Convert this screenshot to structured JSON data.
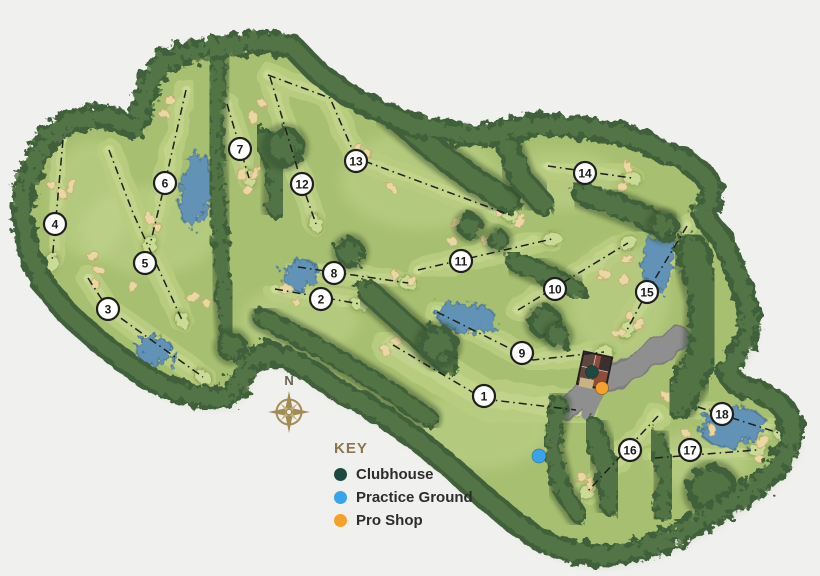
{
  "legend": {
    "title": "KEY",
    "items": [
      {
        "id": "clubhouse",
        "label": "Clubhouse",
        "color": "#1d4a40"
      },
      {
        "id": "practice-ground",
        "label": "Practice Ground",
        "color": "#39a3ec"
      },
      {
        "id": "pro-shop",
        "label": "Pro Shop",
        "color": "#f6a22a"
      }
    ]
  },
  "compass": {
    "label": "N"
  },
  "holes": [
    {
      "number": 1,
      "marker": {
        "x": 484,
        "y": 396
      },
      "route": [
        [
          393,
          345
        ],
        [
          484,
          399
        ],
        [
          576,
          410
        ]
      ]
    },
    {
      "number": 2,
      "marker": {
        "x": 321,
        "y": 299
      },
      "route": [
        [
          275,
          289
        ],
        [
          360,
          304
        ]
      ]
    },
    {
      "number": 3,
      "marker": {
        "x": 108,
        "y": 309
      },
      "route": [
        [
          88,
          278
        ],
        [
          108,
          309
        ],
        [
          203,
          377
        ]
      ]
    },
    {
      "number": 4,
      "marker": {
        "x": 55,
        "y": 224
      },
      "route": [
        [
          63,
          140
        ],
        [
          52,
          262
        ]
      ]
    },
    {
      "number": 5,
      "marker": {
        "x": 145,
        "y": 263
      },
      "route": [
        [
          109,
          150
        ],
        [
          133,
          213
        ],
        [
          182,
          320
        ]
      ]
    },
    {
      "number": 6,
      "marker": {
        "x": 165,
        "y": 183
      },
      "route": [
        [
          186,
          90
        ],
        [
          165,
          183
        ],
        [
          150,
          245
        ]
      ]
    },
    {
      "number": 7,
      "marker": {
        "x": 240,
        "y": 149
      },
      "route": [
        [
          227,
          104
        ],
        [
          249,
          178
        ]
      ]
    },
    {
      "number": 8,
      "marker": {
        "x": 334,
        "y": 273
      },
      "route": [
        [
          298,
          267
        ],
        [
          408,
          283
        ]
      ]
    },
    {
      "number": 9,
      "marker": {
        "x": 522,
        "y": 353
      },
      "route": [
        [
          437,
          312
        ],
        [
          533,
          360
        ],
        [
          604,
          352
        ]
      ]
    },
    {
      "number": 10,
      "marker": {
        "x": 555,
        "y": 289
      },
      "route": [
        [
          518,
          310
        ],
        [
          628,
          243
        ]
      ]
    },
    {
      "number": 11,
      "marker": {
        "x": 461,
        "y": 261
      },
      "route": [
        [
          418,
          270
        ],
        [
          552,
          239
        ]
      ]
    },
    {
      "number": 12,
      "marker": {
        "x": 302,
        "y": 184
      },
      "route": [
        [
          270,
          77
        ],
        [
          302,
          184
        ],
        [
          316,
          224
        ]
      ]
    },
    {
      "number": 13,
      "marker": {
        "x": 356,
        "y": 161
      },
      "route": [
        [
          268,
          75
        ],
        [
          330,
          98
        ],
        [
          356,
          158
        ],
        [
          510,
          215
        ]
      ]
    },
    {
      "number": 14,
      "marker": {
        "x": 585,
        "y": 173
      },
      "route": [
        [
          548,
          166
        ],
        [
          632,
          178
        ]
      ]
    },
    {
      "number": 15,
      "marker": {
        "x": 647,
        "y": 292
      },
      "route": [
        [
          687,
          226
        ],
        [
          647,
          292
        ],
        [
          627,
          330
        ]
      ]
    },
    {
      "number": 16,
      "marker": {
        "x": 630,
        "y": 450
      },
      "route": [
        [
          658,
          416
        ],
        [
          588,
          491
        ]
      ]
    },
    {
      "number": 17,
      "marker": {
        "x": 690,
        "y": 450
      },
      "route": [
        [
          655,
          458
        ],
        [
          757,
          450
        ]
      ]
    },
    {
      "number": 18,
      "marker": {
        "x": 722,
        "y": 414
      },
      "route": [
        [
          698,
          407
        ],
        [
          782,
          434
        ]
      ]
    }
  ],
  "poi": [
    {
      "id": "clubhouse",
      "x": 592,
      "y": 372,
      "r": 6.5,
      "color": "#1d4a40"
    },
    {
      "id": "practice-ground",
      "x": 539,
      "y": 456,
      "r": 7,
      "color": "#39a3ec"
    },
    {
      "id": "pro-shop",
      "x": 602,
      "y": 388,
      "r": 6.5,
      "color": "#f6a22a"
    }
  ],
  "colors": {
    "background": "#f0f0ee",
    "grass": "#a7bf70",
    "fairway": "#b9cd80",
    "fairway_light": "#c9db95",
    "trees": "#41603a",
    "trees_light": "#587a49",
    "water": "#6292b6",
    "water_edge": "#4a789e",
    "sand": "#e9d8a3",
    "sand_edge": "#c6ac74",
    "path": "#8f8f8f",
    "line": "#1f1f1f",
    "marker_fill": "#ffffff",
    "marker_stroke": "#1f1f1f",
    "gold": "#a28c54"
  }
}
